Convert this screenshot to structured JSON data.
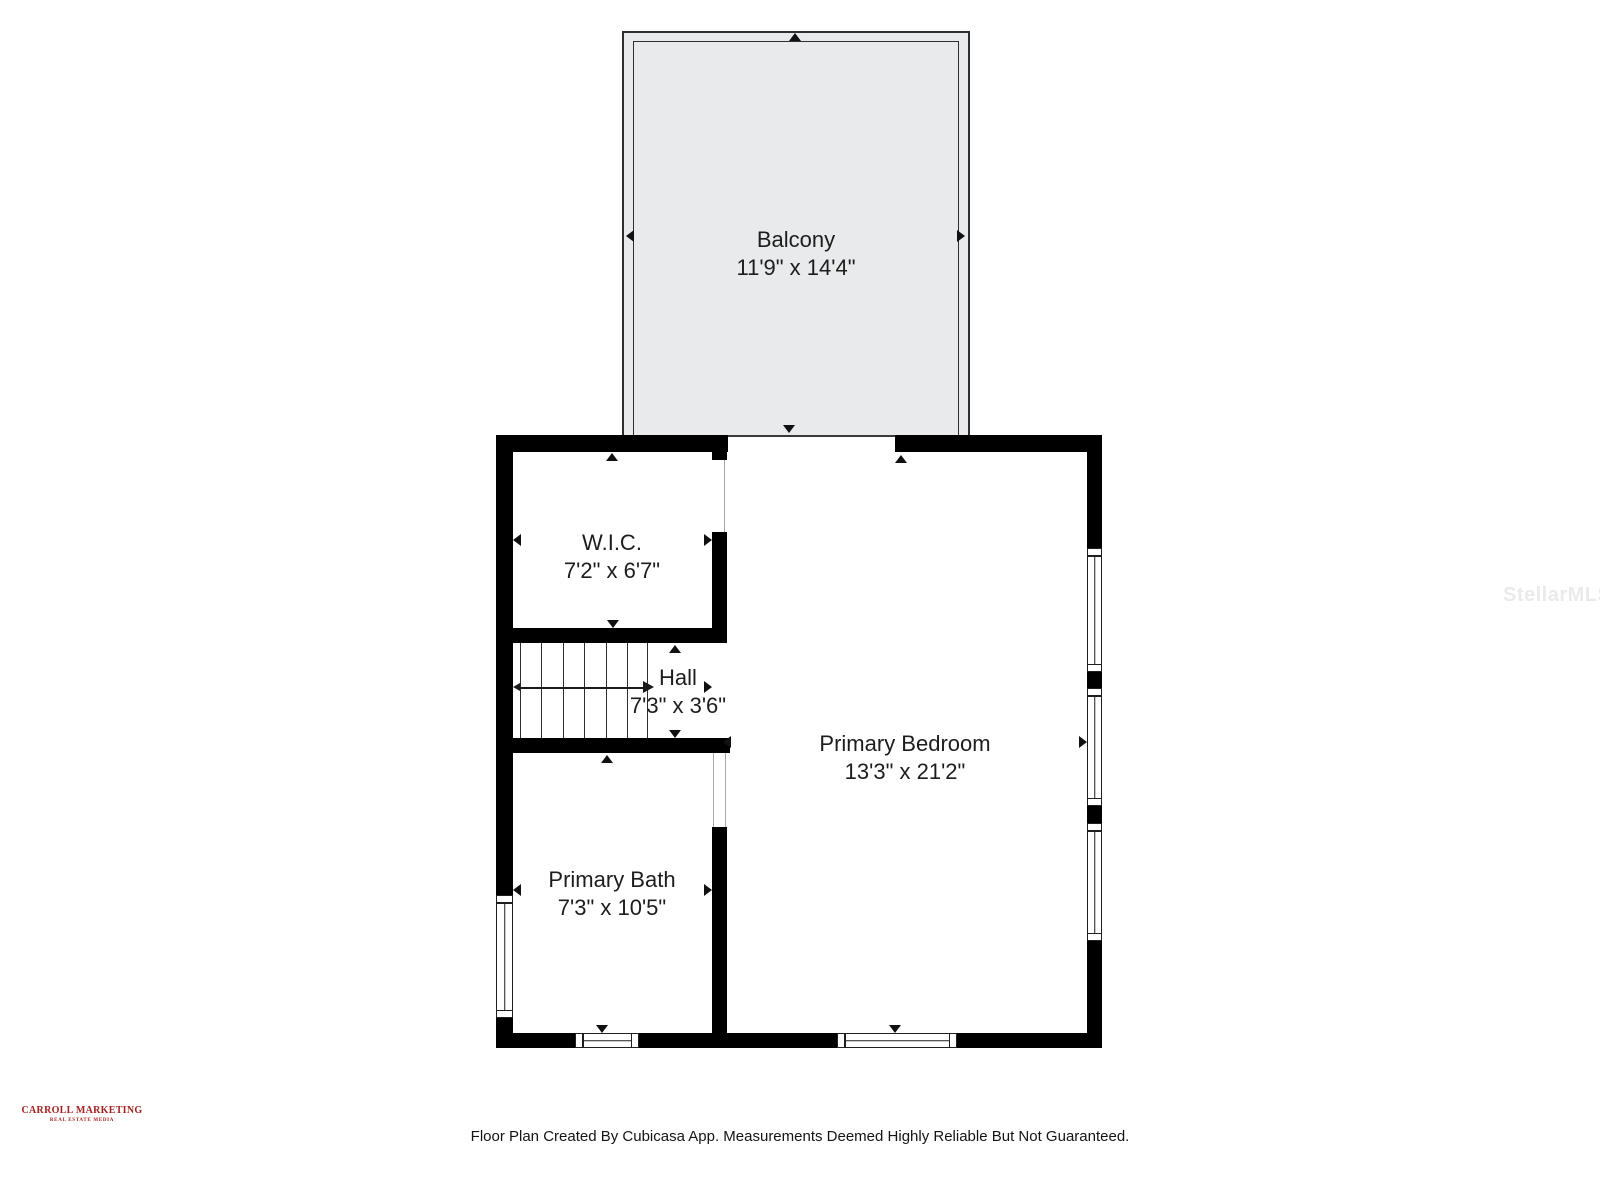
{
  "document": {
    "type": "floor-plan"
  },
  "floorplan": {
    "rooms": {
      "balcony": {
        "name": "Balcony",
        "dims": "11'9\" x 14'4\""
      },
      "wic": {
        "name": "W.I.C.",
        "dims": "7'2\" x 6'7\""
      },
      "hall": {
        "name": "Hall",
        "dims": "7'3\" x 3'6\""
      },
      "primary_bedroom": {
        "name": "Primary Bedroom",
        "dims": "13'3\" x 21'2\""
      },
      "primary_bath": {
        "name": "Primary Bath",
        "dims": "7'3\" x 10'5\""
      }
    },
    "colors": {
      "wall": "#000000",
      "balcony_fill": "#e9eaeb",
      "label_text": "#1d1d1d",
      "logo_red": "#a4211f",
      "watermark_gray": "#eaeaea"
    }
  },
  "watermark": {
    "text": "StellarMLS"
  },
  "logo": {
    "title": "CARROLL MARKETING",
    "subtitle": "REAL ESTATE MEDIA"
  },
  "footer": {
    "disclaimer": "Floor Plan Created By Cubicasa App. Measurements Deemed Highly Reliable But Not Guaranteed."
  }
}
